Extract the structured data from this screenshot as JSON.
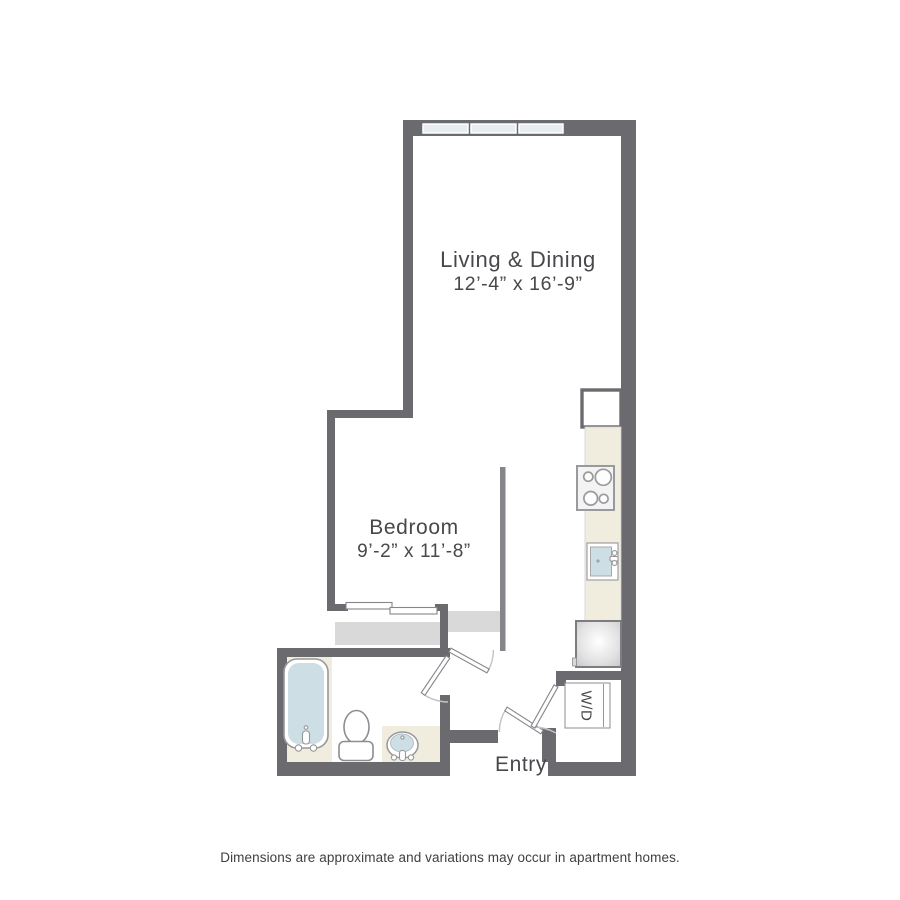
{
  "colors": {
    "wall": "#6b6b6f",
    "interior_wall": "#85858a",
    "counter_cream": "#f0edde",
    "fixture_blue": "#cddee5",
    "window_blue": "#e8eef0",
    "closet_gray": "#d9d9da",
    "fixture_stroke": "#97979b",
    "arc_gray": "#c3c3c5",
    "text": "#48484c"
  },
  "rooms": {
    "living_dining": {
      "label": "Living & Dining",
      "dimensions": "12’-4” x 16’-9”"
    },
    "bedroom": {
      "label": "Bedroom",
      "dimensions": "9’-2” x 11’-8”"
    },
    "entry": {
      "label": "Entry"
    },
    "laundry": {
      "label": "W/D"
    }
  },
  "footer": {
    "disclaimer": "Dimensions are approximate and variations may occur in apartment homes."
  }
}
